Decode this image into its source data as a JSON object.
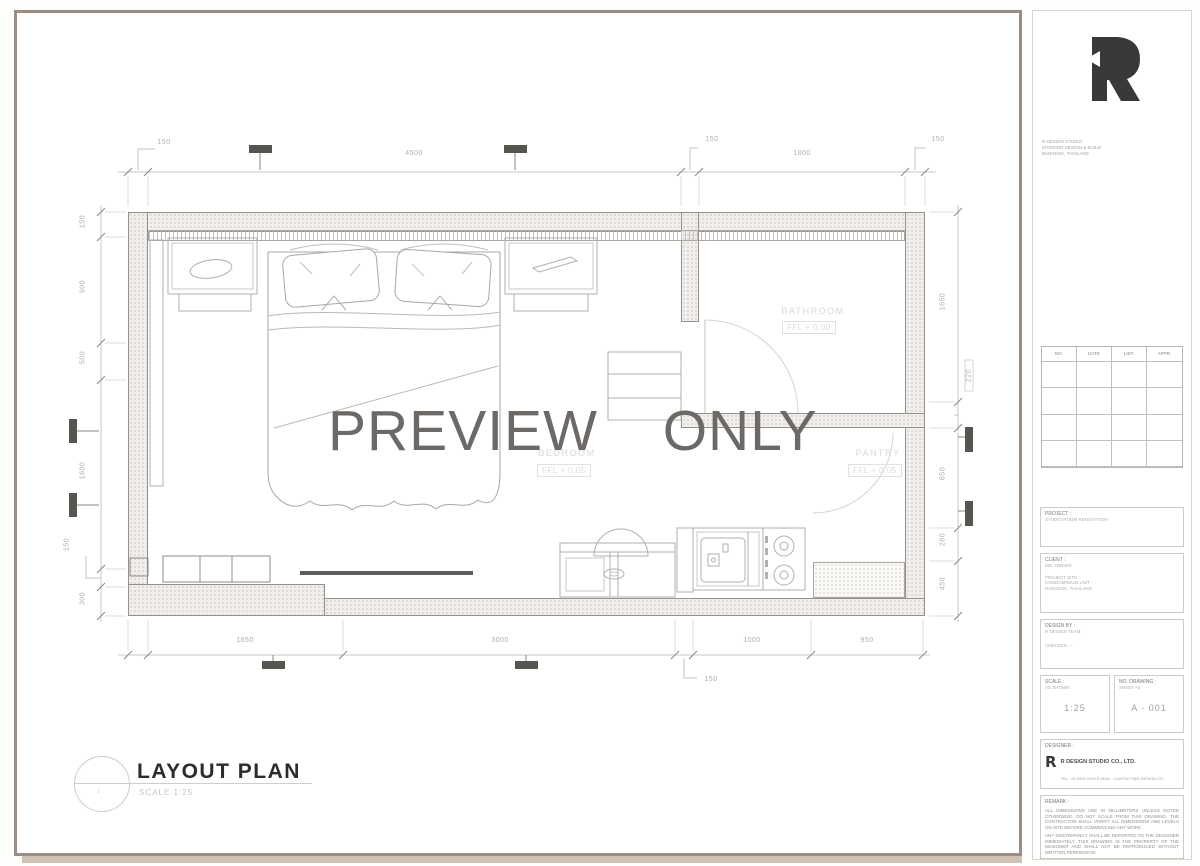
{
  "sheet": {
    "watermark": "PREVIEW ONLY",
    "title": {
      "number": "1",
      "label": "LAYOUT PLAN",
      "scale": "SCALE 1:25"
    }
  },
  "rooms": {
    "bathroom": {
      "name": "BATHROOM",
      "level": "FFL + 0.00"
    },
    "bedroom": {
      "name": "BEDROOM",
      "level": "FFL + 0.05"
    },
    "pantry": {
      "name": "PANTRY",
      "level": "FFL + 0.05"
    }
  },
  "dims": {
    "top": [
      "150",
      "4500",
      "150",
      "1800",
      "150"
    ],
    "bottom": [
      "1650",
      "3000",
      "150",
      "1000",
      "950"
    ],
    "left": [
      "150",
      "900",
      "500",
      "1600",
      "150",
      "300"
    ],
    "right": [
      "1650",
      "220",
      "850",
      "280",
      "450"
    ]
  },
  "colors": {
    "sheet_border": "#9c8d84",
    "sheet_shadow": "#cfc2b5",
    "watermark": "#6c6967",
    "logo": "#3a3839"
  },
  "title_block": {
    "logo_letter": "R",
    "studio_note": [
      "R DESIGN STUDIO",
      "INTERIOR DESIGN & BUILD",
      "BANGKOK, THAILAND"
    ],
    "revision": {
      "headers": [
        "NO.",
        "DATE",
        "LIST.",
        "APPR."
      ]
    },
    "project": {
      "label": "PROJECT :",
      "value": "STUDIO ROOM RENOVATION"
    },
    "client": {
      "label": "CLIENT :",
      "value": "MR. OWNER",
      "lines": [
        "PROJECT SITE :",
        "CONDOMINIUM UNIT",
        "BANGKOK, THAILAND"
      ]
    },
    "drawn": {
      "label": "DESIGN BY :",
      "value": "R DESIGN TEAM",
      "line": "CHECKED : -"
    },
    "scale": {
      "label": "SCALE :",
      "sub": "AS SHOWN",
      "value": "1:25"
    },
    "drawing_no": {
      "label": "NO. DRAWING :",
      "sub": "SHEET A4",
      "value": "A - 001"
    },
    "company": {
      "label": "DESIGNER :",
      "logo_letter": "R",
      "name": "R DESIGN STUDIO CO., LTD.",
      "contact": "TEL : 00 0000 0000   E-MAIL : CONTACT@R-DESIGN.CO"
    },
    "note": {
      "label": "REMARK :",
      "para1": "ALL DIMENSIONS ARE IN MILLIMETERS UNLESS NOTED OTHERWISE. DO NOT SCALE FROM THIS DRAWING. THE CONTRACTOR SHALL VERIFY ALL DIMENSIONS AND LEVELS ON SITE BEFORE COMMENCING ANY WORK.",
      "para2": "ANY DISCREPANCY SHALL BE REPORTED TO THE DESIGNER IMMEDIATELY. THIS DRAWING IS THE PROPERTY OF THE DESIGNER AND SHALL NOT BE REPRODUCED WITHOUT WRITTEN PERMISSION."
    }
  }
}
